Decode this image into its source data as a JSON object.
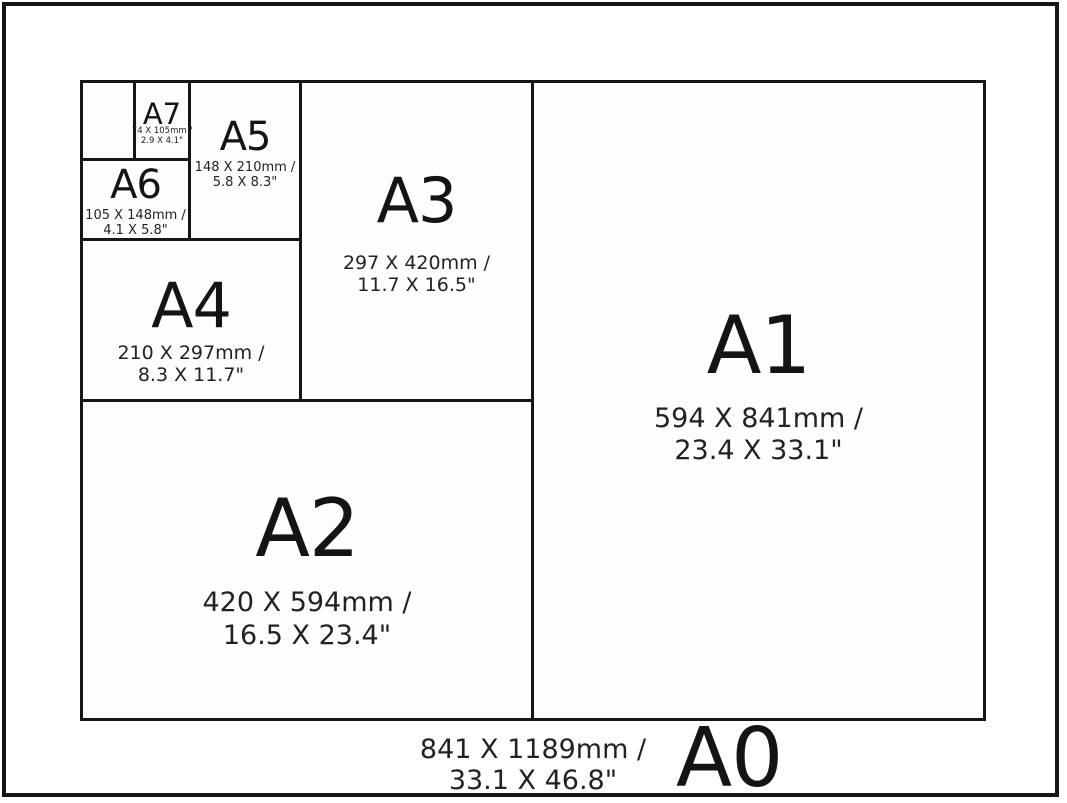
{
  "colors": {
    "background": "#ffffff",
    "line": "#161616",
    "text": "#1b1b1b"
  },
  "sizes": {
    "a7": {
      "label": "A7",
      "mm": "74 X 105mm /",
      "inches": "2.9 X 4.1\""
    },
    "a6": {
      "label": "A6",
      "mm": "105 X 148mm /",
      "inches": "4.1 X 5.8\""
    },
    "a5": {
      "label": "A5",
      "mm": "148 X 210mm /",
      "inches": "5.8 X 8.3\""
    },
    "a4": {
      "label": "A4",
      "mm": "210 X 297mm /",
      "inches": "8.3 X 11.7\""
    },
    "a3": {
      "label": "A3",
      "mm": "297 X 420mm /",
      "inches": "11.7 X 16.5\""
    },
    "a2": {
      "label": "A2",
      "mm": "420 X 594mm /",
      "inches": "16.5 X 23.4\""
    },
    "a1": {
      "label": "A1",
      "mm": "594 X 841mm /",
      "inches": "23.4 X 33.1\""
    },
    "a0": {
      "label": "A0",
      "mm": "841 X 1189mm /",
      "inches": "33.1 X 46.8\""
    }
  }
}
